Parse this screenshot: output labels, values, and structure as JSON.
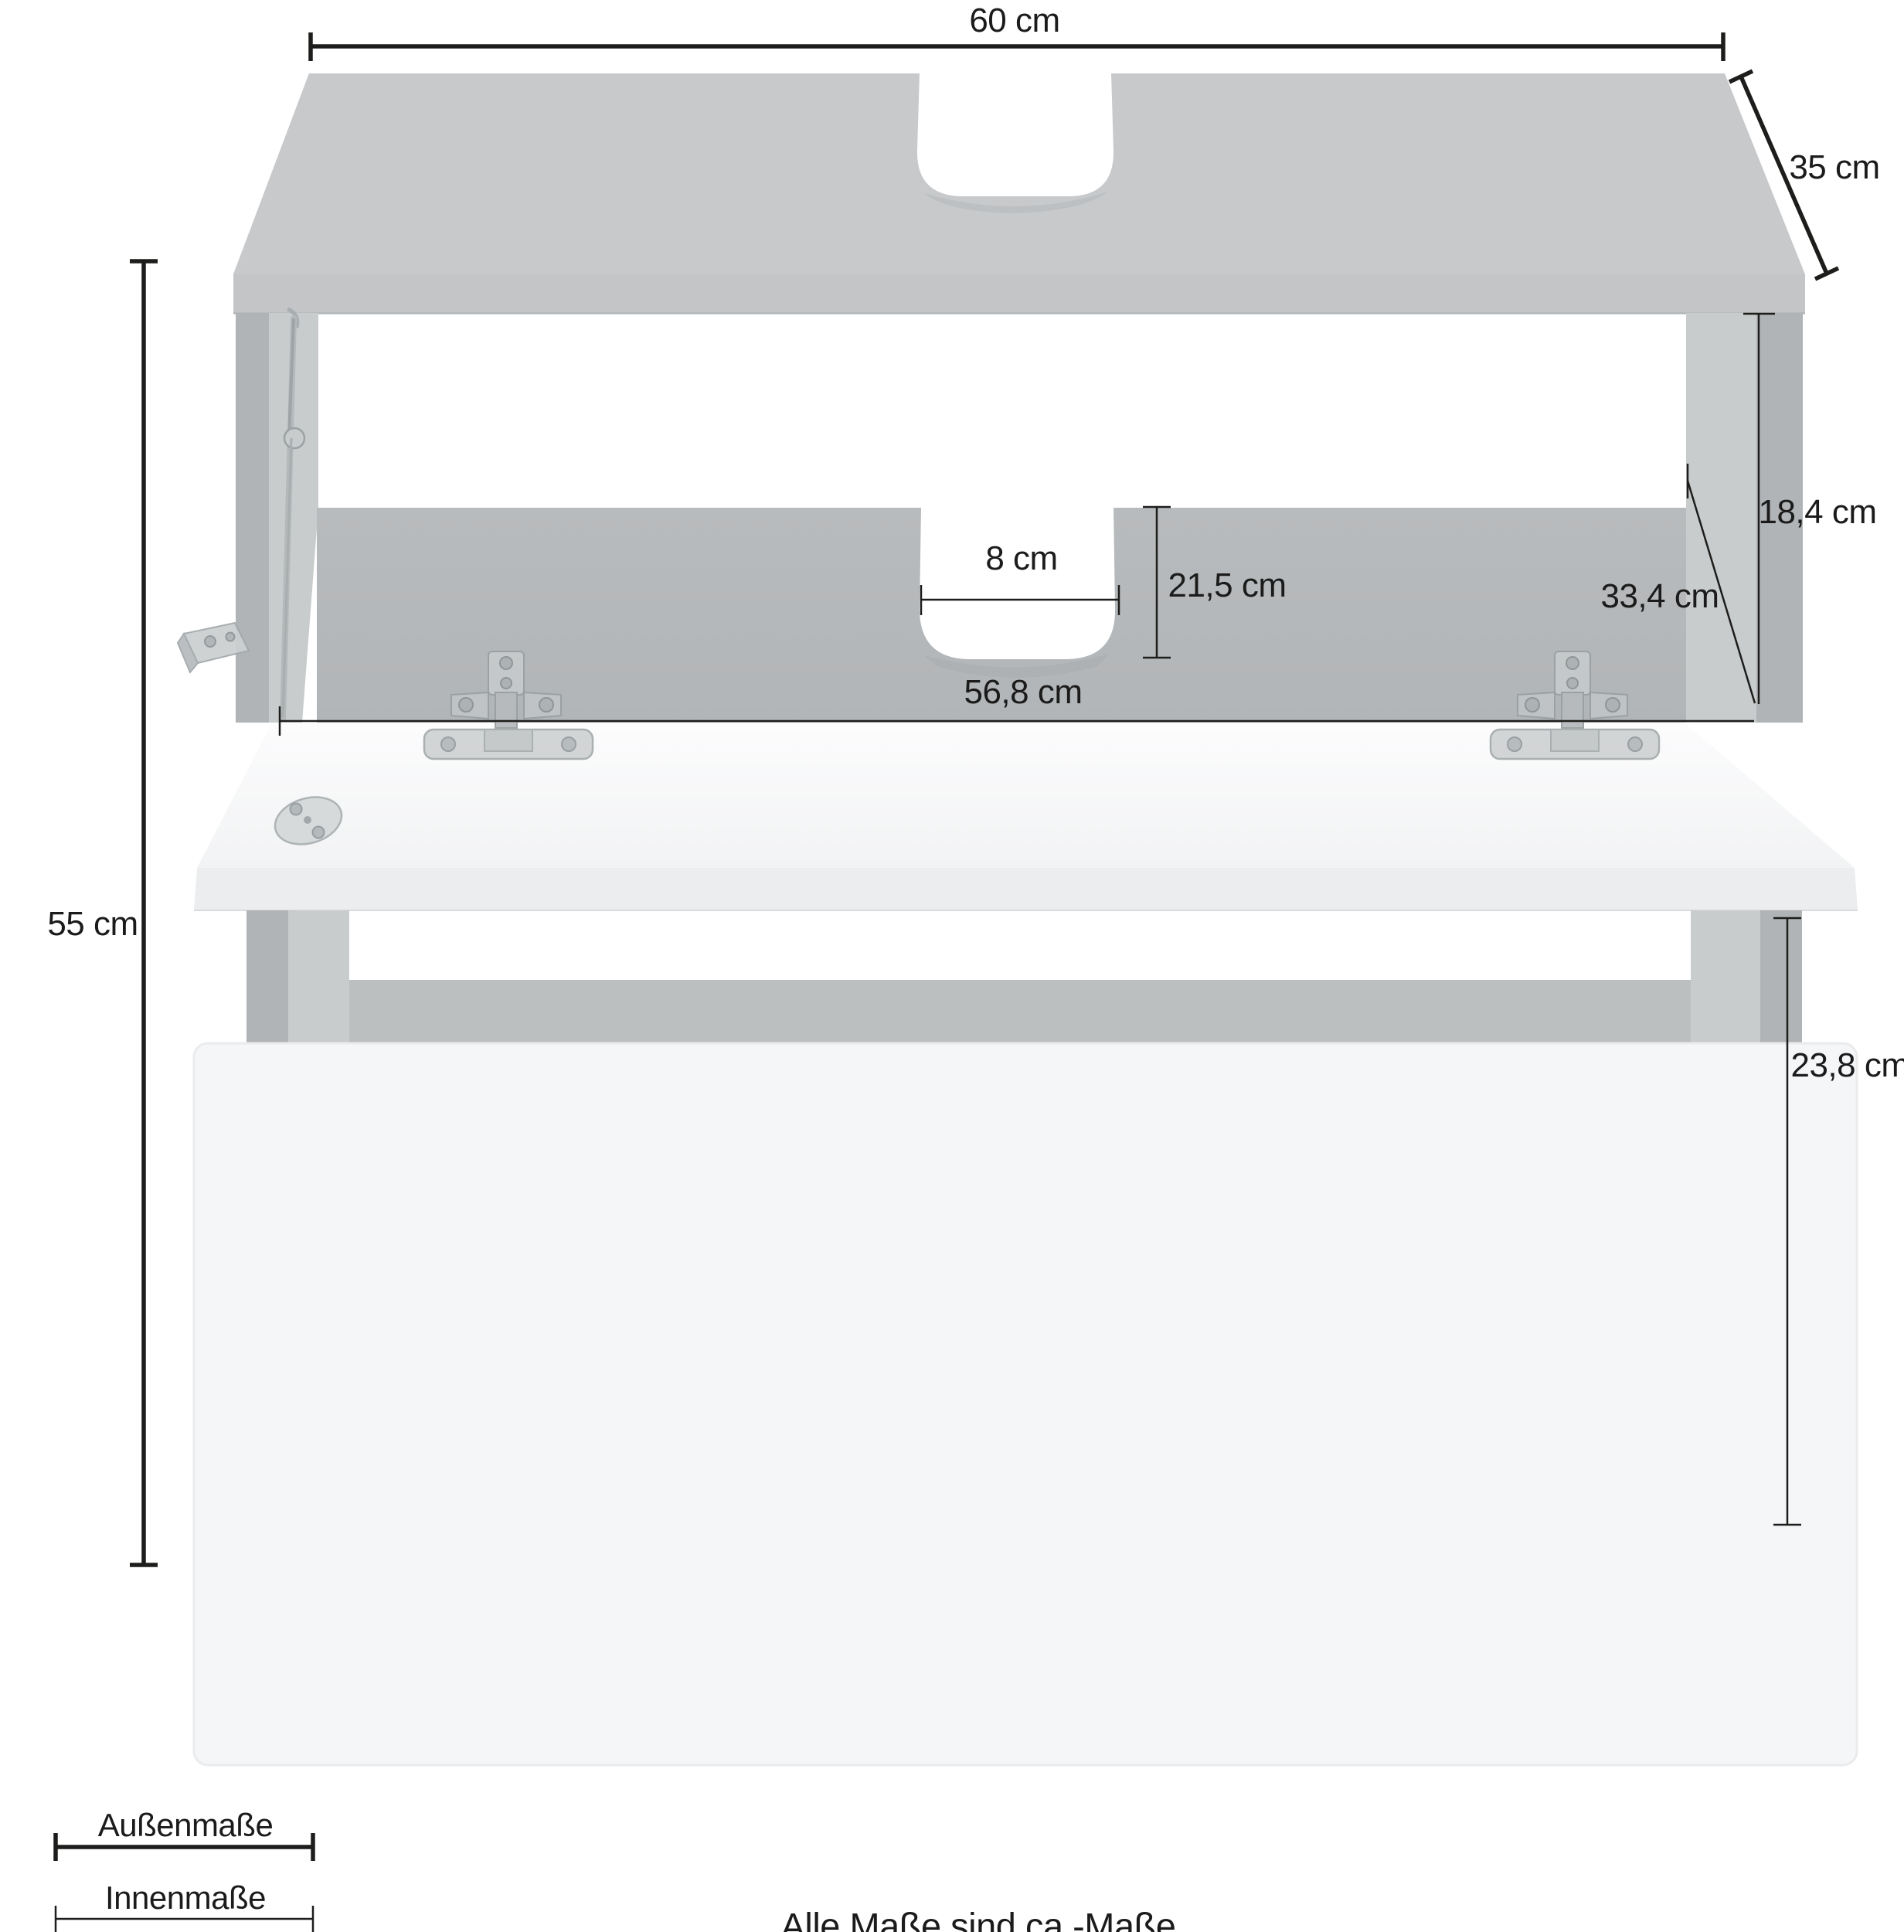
{
  "dimensions": {
    "outer_width": "60 cm",
    "outer_depth": "35 cm",
    "outer_height": "55 cm",
    "inner_clearance_height": "18,4 cm",
    "inner_depth": "33,4 cm",
    "siphon_cutout_width": "8 cm",
    "siphon_cutout_depth": "21,5 cm",
    "inner_width": "56,8 cm",
    "drawer_inner_height": "23,8 cm"
  },
  "legend": {
    "outer": "Außenmaße",
    "inner": "Innenmaße"
  },
  "footnote": "Alle Maße sind ca.-Maße",
  "colors": {
    "background": "#ffffff",
    "dimension_line": "#1d1d1b",
    "panel_gray_top": "#c7c9cb",
    "panel_gray_side": "#b1b4b6",
    "panel_gray_inner": "#c9cccd",
    "front_white": "#f5f6f7",
    "hardware_metal": "#c6cacb"
  }
}
